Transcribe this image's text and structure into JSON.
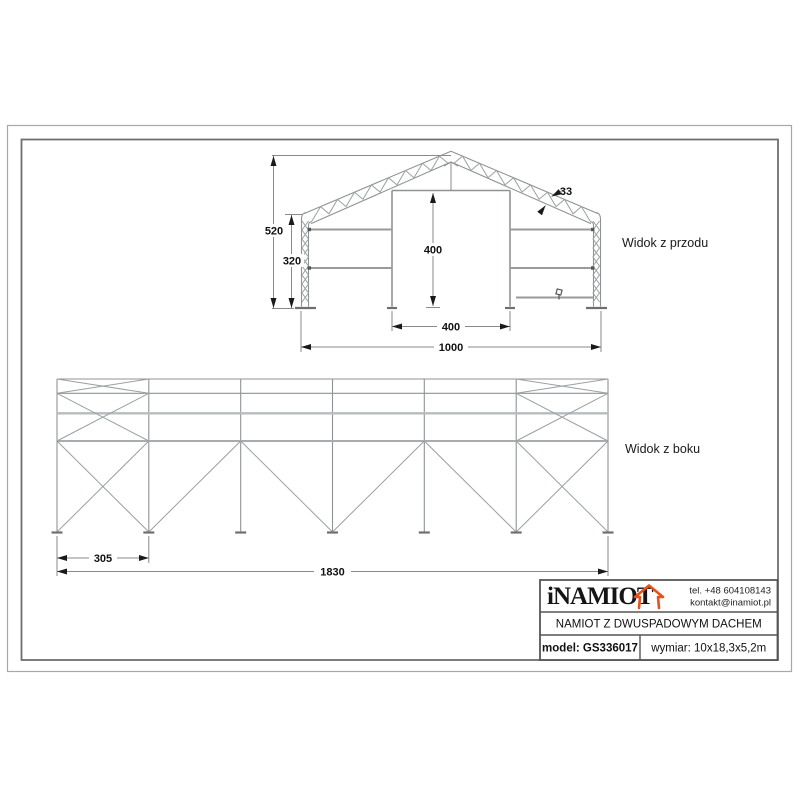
{
  "drawing": {
    "front_view": {
      "label": "Widok z przodu",
      "dim_total_height": "520",
      "dim_wall_height": "320",
      "dim_door_height": "400",
      "dim_door_width": "400",
      "dim_total_width": "1000",
      "dim_truss_depth": "33"
    },
    "side_view": {
      "label": "Widok z boku",
      "dim_end_bay": "305",
      "dim_total_length": "1830"
    }
  },
  "title_block": {
    "logo": "iNAMIOT",
    "logo_icon": "tent-house-icon",
    "phone": "tel. +48 604108143",
    "email": "kontakt@inamiot.pl",
    "title": "NAMIOT Z DWUSPADOWYM DACHEM",
    "model": "model: GS336017",
    "size": "wymiar: 10x18,3x5,2m",
    "accent": "#e8501e"
  }
}
